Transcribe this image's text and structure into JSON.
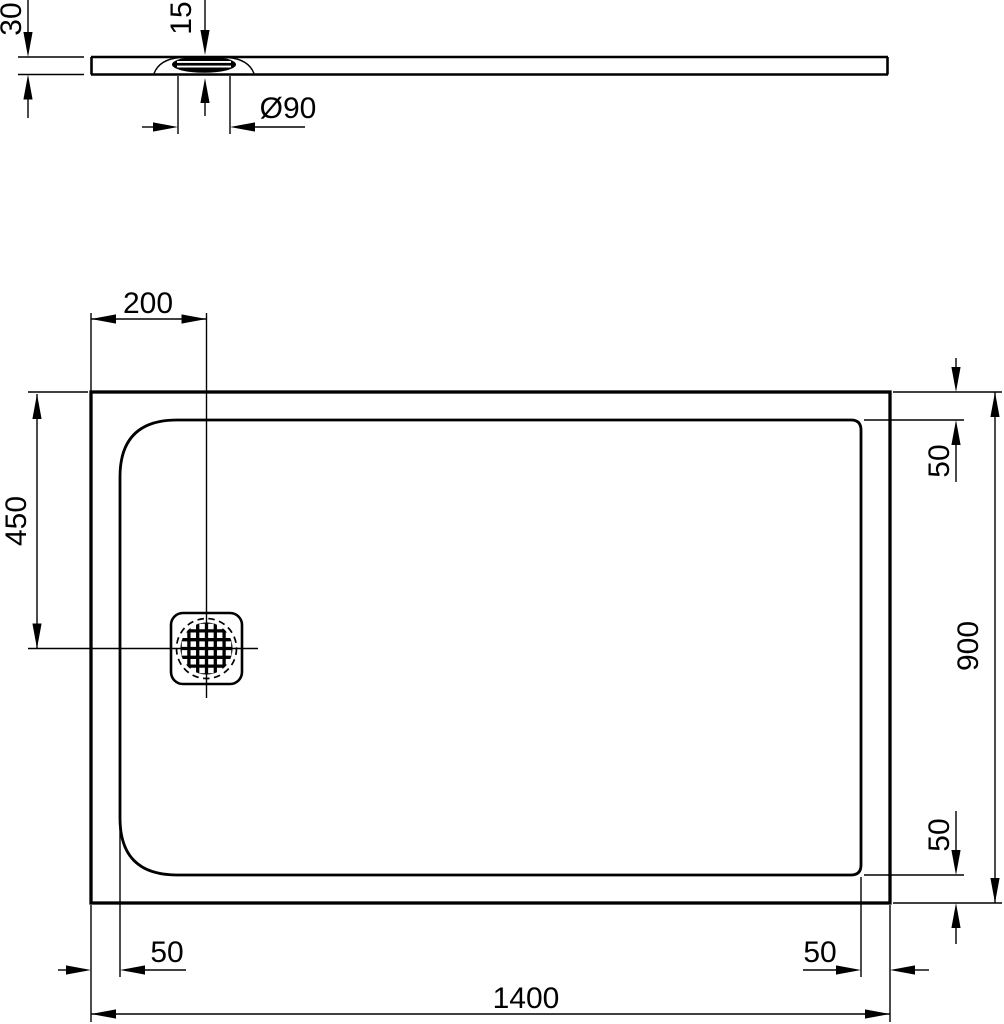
{
  "drawing": {
    "background_color": "#ffffff",
    "line_color": "#000000",
    "side_view": {
      "thickness_label": "30",
      "drain_height_label": "15",
      "drain_diameter_label": "Ø90"
    },
    "plan_view": {
      "drain_offset_x_label": "200",
      "drain_offset_y_label": "450",
      "top_edge_inset_label": "50",
      "overall_depth_label": "900",
      "bottom_edge_inset_label": "50",
      "left_edge_inset_label": "50",
      "right_edge_inset_label": "50",
      "overall_width_label": "1400"
    }
  }
}
